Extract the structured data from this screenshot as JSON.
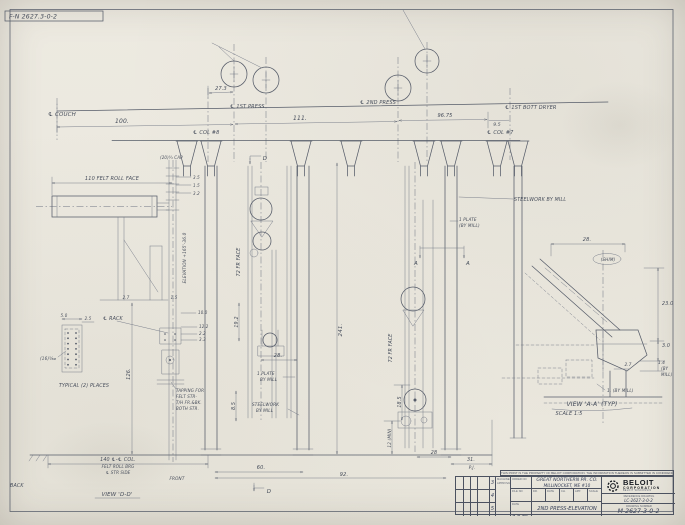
{
  "stamp_number": "F-N 2627.3-0-2",
  "labels": [
    {
      "t": "℄ COUCH",
      "x": 48,
      "y": 116,
      "s": 5.5,
      "a": "start"
    },
    {
      "t": "100.",
      "x": 122,
      "y": 123,
      "s": 6
    },
    {
      "t": "27.3",
      "x": 221,
      "y": 90,
      "s": 5
    },
    {
      "t": "℄ 1ST PRESS",
      "x": 230,
      "y": 108,
      "s": 5,
      "a": "start"
    },
    {
      "t": "111.",
      "x": 300,
      "y": 120,
      "s": 6
    },
    {
      "t": "℄ 2ND PRESS",
      "x": 360,
      "y": 104,
      "s": 5,
      "a": "start"
    },
    {
      "t": "96.75",
      "x": 445,
      "y": 117,
      "s": 5
    },
    {
      "t": "9.5",
      "x": 497,
      "y": 126,
      "s": 4.5
    },
    {
      "t": "℄ 1ST BOTT DRYER",
      "x": 505,
      "y": 109,
      "s": 5,
      "a": "start"
    },
    {
      "t": "℄ COL #8",
      "x": 193,
      "y": 134,
      "s": 5,
      "a": "start"
    },
    {
      "t": "℄ COL #7",
      "x": 487,
      "y": 134,
      "s": 5,
      "a": "start"
    },
    {
      "t": "(20)¾ CAP",
      "x": 160,
      "y": 159,
      "s": 4,
      "a": "start"
    },
    {
      "t": "D",
      "x": 265,
      "y": 160,
      "s": 5.5
    },
    {
      "t": "110 FELT ROLL FACE",
      "x": 112,
      "y": 180,
      "s": 5
    },
    {
      "t": "3.5",
      "x": 193,
      "y": 179,
      "s": 4,
      "a": "start"
    },
    {
      "t": "1.5",
      "x": 193,
      "y": 187,
      "s": 4,
      "a": "start"
    },
    {
      "t": "3.2",
      "x": 193,
      "y": 195,
      "s": 4,
      "a": "start"
    },
    {
      "t": "10.0",
      "x": 198,
      "y": 314,
      "s": 4,
      "a": "start"
    },
    {
      "t": "12.2",
      "x": 199,
      "y": 328,
      "s": 4,
      "a": "start"
    },
    {
      "t": "2.2",
      "x": 199,
      "y": 335,
      "s": 4,
      "a": "start"
    },
    {
      "t": "3.3",
      "x": 199,
      "y": 341,
      "s": 4,
      "a": "start"
    },
    {
      "t": "STEELWORK BY MILL",
      "x": 514,
      "y": 201,
      "s": 4.8,
      "a": "start"
    },
    {
      "t": "1 PLATE",
      "x": 459,
      "y": 221,
      "s": 4.2,
      "a": "start"
    },
    {
      "t": "(BY MILL)",
      "x": 459,
      "y": 227,
      "s": 4.2,
      "a": "start"
    },
    {
      "t": "ELEVATION +165'-36.0",
      "x": 186,
      "y": 258,
      "s": 4.2,
      "r": -90
    },
    {
      "t": "72 FR FACE",
      "x": 240,
      "y": 262,
      "s": 4.8,
      "r": -90
    },
    {
      "t": "72 FR FACE",
      "x": 392,
      "y": 348,
      "s": 4.8,
      "r": -90
    },
    {
      "t": "241.",
      "x": 342,
      "y": 330,
      "s": 5.5,
      "r": -90
    },
    {
      "t": "126.",
      "x": 130,
      "y": 374,
      "s": 5,
      "r": -90
    },
    {
      "t": "19.2",
      "x": 238,
      "y": 322,
      "s": 4.8,
      "r": -90
    },
    {
      "t": "8.5",
      "x": 235,
      "y": 406,
      "s": 4.8,
      "r": -90
    },
    {
      "t": "18.5",
      "x": 401,
      "y": 402,
      "s": 4.8,
      "r": -90
    },
    {
      "t": "12 (MIN)",
      "x": 391,
      "y": 438,
      "s": 4.2,
      "r": -90
    },
    {
      "t": "A",
      "x": 416,
      "y": 265,
      "s": 5.5
    },
    {
      "t": "A",
      "x": 468,
      "y": 265,
      "s": 5.5
    },
    {
      "t": "28.",
      "x": 278,
      "y": 357,
      "s": 5
    },
    {
      "t": "1 PLATE",
      "x": 257,
      "y": 375,
      "s": 4.2,
      "a": "start"
    },
    {
      "t": "BY MILL",
      "x": 260,
      "y": 381,
      "s": 4.2,
      "a": "start"
    },
    {
      "t": "STEELWORK",
      "x": 252,
      "y": 406,
      "s": 4.2,
      "a": "start"
    },
    {
      "t": "BY MILL",
      "x": 256,
      "y": 412,
      "s": 4.2,
      "a": "start"
    },
    {
      "t": "℄ RACK",
      "x": 103,
      "y": 320,
      "s": 4.8,
      "a": "start"
    },
    {
      "t": "5.0",
      "x": 64,
      "y": 317,
      "s": 4
    },
    {
      "t": "2.5",
      "x": 88,
      "y": 320,
      "s": 4
    },
    {
      "t": "(16)⅝⌀",
      "x": 40,
      "y": 360,
      "s": 4.2,
      "a": "start"
    },
    {
      "t": "TYPICAL (2) PLACES",
      "x": 84,
      "y": 387,
      "s": 4.8
    },
    {
      "t": "TAPPING FOR",
      "x": 176,
      "y": 392,
      "s": 4,
      "a": "start"
    },
    {
      "t": "FELT STR-",
      "x": 176,
      "y": 398,
      "s": 4,
      "a": "start"
    },
    {
      "t": "T/H FR.&BK.",
      "x": 176,
      "y": 404,
      "s": 4,
      "a": "start"
    },
    {
      "t": "BOTH STR.",
      "x": 176,
      "y": 410,
      "s": 4,
      "a": "start"
    },
    {
      "t": "2.7",
      "x": 126,
      "y": 299,
      "s": 4
    },
    {
      "t": "1.5",
      "x": 174,
      "y": 299,
      "s": 4
    },
    {
      "t": "140 ℄-℄ COL.",
      "x": 118,
      "y": 461,
      "s": 4.8
    },
    {
      "t": "FELT ROLL BRG",
      "x": 118,
      "y": 468,
      "s": 4
    },
    {
      "t": "℄ STR SIDE",
      "x": 118,
      "y": 474,
      "s": 4
    },
    {
      "t": "BACK",
      "x": 10,
      "y": 487,
      "s": 4.8,
      "a": "start"
    },
    {
      "t": "FRONT",
      "x": 177,
      "y": 480,
      "s": 4.2
    },
    {
      "t": "60.",
      "x": 261,
      "y": 469,
      "s": 5
    },
    {
      "t": "92.",
      "x": 344,
      "y": 476,
      "s": 5
    },
    {
      "t": "28",
      "x": 434,
      "y": 454,
      "s": 4.8
    },
    {
      "t": "31.",
      "x": 471,
      "y": 461,
      "s": 4.8
    },
    {
      "t": "VIEW 'D-D'",
      "x": 117,
      "y": 496,
      "s": 5.5
    },
    {
      "t": "D",
      "x": 269,
      "y": 493,
      "s": 5.5
    },
    {
      "t": "28.",
      "x": 587,
      "y": 241,
      "s": 5
    },
    {
      "t": "(SHIM)",
      "x": 608,
      "y": 261,
      "s": 4.2
    },
    {
      "t": "23.0",
      "x": 662,
      "y": 305,
      "s": 4.8,
      "a": "start"
    },
    {
      "t": "3.0",
      "x": 662,
      "y": 347,
      "s": 4.8,
      "a": "start"
    },
    {
      "t": "1.4",
      "x": 658,
      "y": 364,
      "s": 4.2,
      "a": "start"
    },
    {
      "t": "(BY",
      "x": 661,
      "y": 370,
      "s": 4,
      "a": "start"
    },
    {
      "t": "MILL)",
      "x": 661,
      "y": 376,
      "s": 4,
      "a": "start"
    },
    {
      "t": "2.7",
      "x": 628,
      "y": 366,
      "s": 4.2
    },
    {
      "t": "1. (BY MILL)",
      "x": 607,
      "y": 392,
      "s": 4.2,
      "a": "start"
    },
    {
      "t": "VIEW 'A-A' (TYP)",
      "x": 592,
      "y": 406,
      "s": 6
    },
    {
      "t": "SCALE 1:5",
      "x": 569,
      "y": 415,
      "s": 5
    },
    {
      "t": "P.J.",
      "x": 472,
      "y": 469,
      "s": 4.2
    }
  ],
  "title_block": {
    "disclaimer": "THIS PRINT IS THE PROPERTY OF BELOIT CORPORATION. THE INFORMATION THEREON IS SUBMITTED IN CONFIDENCE",
    "revisions": [
      "3",
      "4",
      "5"
    ],
    "approval_line1": "MACHINE",
    "approval_line2": "APPROVAL",
    "order_label": "ORDER NO",
    "order_no": "13775",
    "file_label": "FILE NO",
    "file_no": "631",
    "date_label": "DATE",
    "date": "7-7-78",
    "customer_line1": "GREAT NORTHERN PR. CO.",
    "customer_line2": "MILLINOCKET, ME #10",
    "cells": [
      {
        "h": "DR.",
        "v": "KOS"
      },
      {
        "h": "DATE",
        "v": "2-27"
      },
      {
        "h": "CH.",
        "v": "CAB"
      },
      {
        "h": "APP.",
        "v": "WGH"
      },
      {
        "h": "SCALE",
        "v": "1/10"
      }
    ],
    "title": "2ND PRESS-ELEVATION",
    "brand": "BELOIT",
    "brand_sub": "CORPORATION",
    "brand_tag": "BELOIT WISCONSIN",
    "reference_label": "REFERENCE DRAWING",
    "reference_no": "LC-2627-3-0-2",
    "number_label": "DRAWING NUMBER",
    "drawing_no": "M-2627-3-0-2"
  }
}
